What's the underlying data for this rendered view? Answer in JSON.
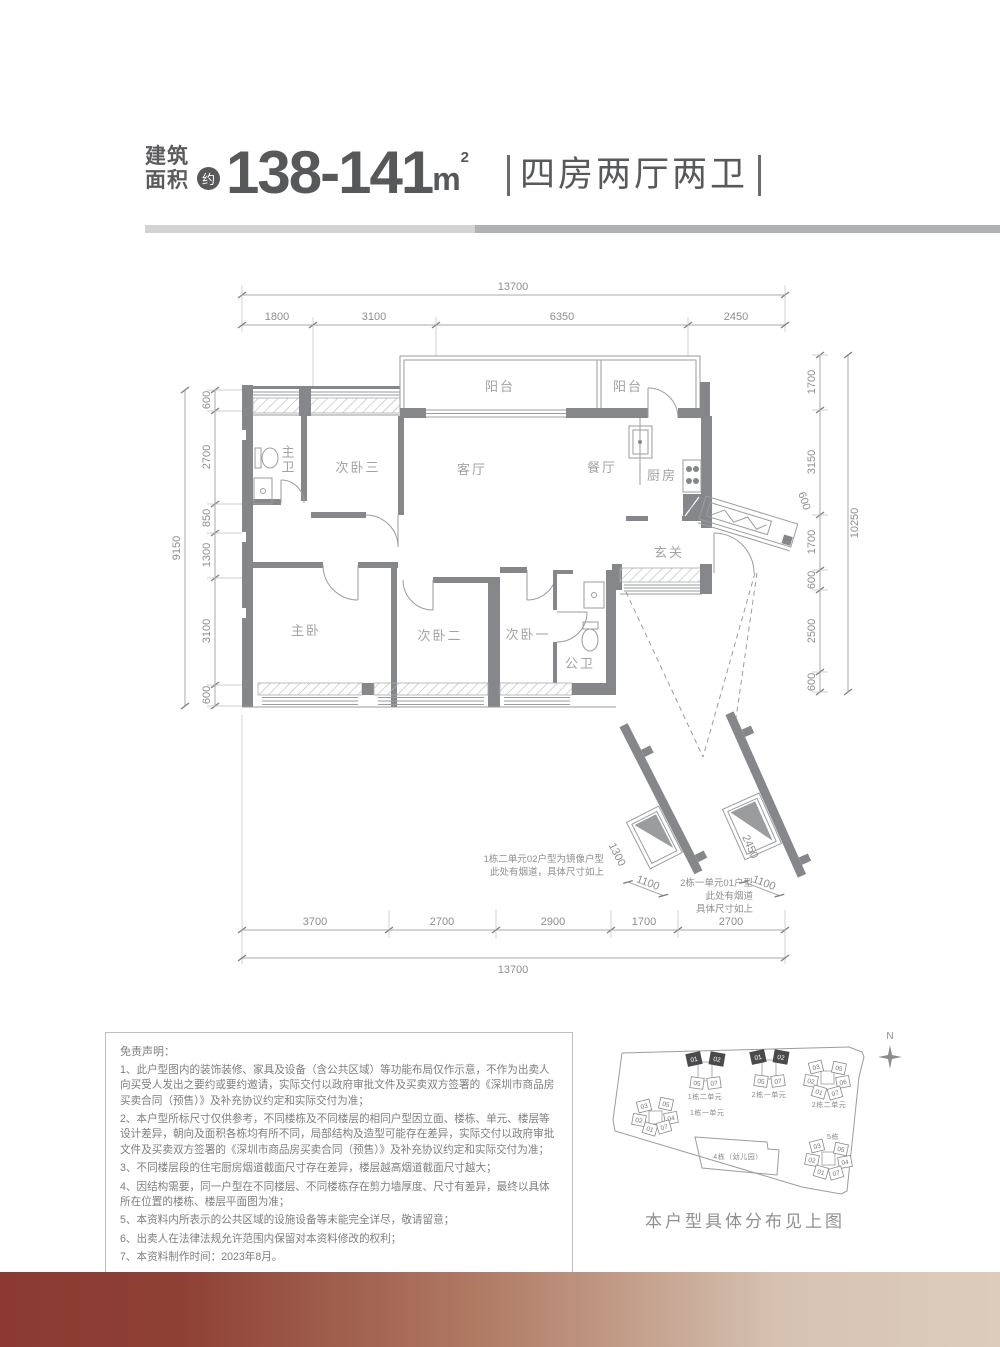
{
  "header": {
    "area_label_line1": "建筑",
    "area_label_line2": "面积",
    "approx_badge": "约",
    "area_value": "138-141",
    "area_unit": "m",
    "area_unit_sup": "2",
    "layout_text": "四房两厅两卫"
  },
  "floor_plan": {
    "rooms": {
      "balcony_left": "阳台",
      "balcony_right": "阳台",
      "master_bath": "主卫",
      "bedroom3": "次卧三",
      "living_room": "客厅",
      "dining_room": "餐厅",
      "kitchen": "厨房",
      "foyer": "玄关",
      "master_bedroom": "主卧",
      "bedroom2": "次卧二",
      "bedroom1": "次卧一",
      "public_bath": "公卫",
      "flue": "烟道"
    },
    "dims_top": {
      "overall": "13700",
      "segments": [
        "1800",
        "3100",
        "6350",
        "2450"
      ]
    },
    "dims_bottom": {
      "overall": "13700",
      "segments": [
        "3700",
        "2700",
        "2900",
        "1700",
        "2700"
      ]
    },
    "dims_left": {
      "overall": "9150",
      "segments": [
        "600",
        "2700",
        "850",
        "1300",
        "3100",
        "600"
      ]
    },
    "dims_right": {
      "overall": "10250",
      "segments": [
        "1700",
        "3150",
        "1700",
        "600",
        "2500",
        "600"
      ],
      "corridor_dim": "600"
    },
    "annotations": [
      {
        "lines": [
          "1栋二单元02户型为镜像户型",
          "此处有烟道，具体尺寸如上"
        ],
        "dims": [
          "1300",
          "1100"
        ]
      },
      {
        "lines": [
          "2栋一单元01户型",
          "此处有烟道",
          "具体尺寸如上"
        ],
        "dims": [
          "2450",
          "1100"
        ]
      }
    ]
  },
  "disclaimer": {
    "title": "免责声明：",
    "items": [
      "1、此户型图内的装饰装修、家具及设备（含公共区域）等功能布局仅作示意，不作为出卖人向买受人发出之要约或要约邀请，实际交付以政府审批文件及买卖双方签署的《深圳市商品房买卖合同（预售）》及补充协议约定和实际交付为准；",
      "2、本户型所标尺寸仅供参考，不同楼栋及不同楼层的相同户型因立面、楼栋、单元、楼层等设计差异，朝向及面积各栋均有所不同，局部结构及造型可能存在差异，实际交付以政府审批文件及买卖双方签署的《深圳市商品房买卖合同（预售）》及补充协议约定和实际交付为准；",
      "3、不同楼层段的住宅厨房烟道截面尺寸存在差异，楼层越高烟道截面尺寸越大；",
      "4、因结构需要，同一户型在不同楼层、不同楼栋存在剪力墙厚度、尺寸有差异，最终以具体所在位置的楼栋、楼层平面图为准；",
      "5、本资料内所表示的公共区域的设施设备等未能完全详尽，敬请留意；",
      "6、出卖人在法律法规允许范围内保留对本资料修改的权利；",
      "7、本资料制作时间：2023年8月。"
    ]
  },
  "site_plan": {
    "north_label": "N",
    "caption": "本户型具体分布见上图",
    "clusters": [
      {
        "label": "1栋二单元",
        "units": [
          {
            "n": "01",
            "dark": true
          },
          {
            "n": "02",
            "dark": true
          },
          {
            "n": "05",
            "dark": false
          },
          {
            "n": "07",
            "dark": false
          }
        ]
      },
      {
        "label": "2栋一单元",
        "units": [
          {
            "n": "01",
            "dark": true
          },
          {
            "n": "02",
            "dark": true
          },
          {
            "n": "05",
            "dark": false
          },
          {
            "n": "07",
            "dark": false
          }
        ]
      },
      {
        "label": "2栋二单元",
        "units": [
          {
            "n": "03",
            "dark": false
          },
          {
            "n": "05",
            "dark": false
          },
          {
            "n": "02",
            "dark": false
          },
          {
            "n": "06",
            "dark": false
          },
          {
            "n": "01",
            "dark": false
          },
          {
            "n": "07",
            "dark": false
          }
        ]
      },
      {
        "label": "1栋一单元",
        "units": [
          {
            "n": "03",
            "dark": false
          },
          {
            "n": "05",
            "dark": false
          },
          {
            "n": "02",
            "dark": false
          },
          {
            "n": "04",
            "dark": false
          },
          {
            "n": "01",
            "dark": false
          },
          {
            "n": "07",
            "dark": false
          }
        ]
      },
      {
        "label": "5栋",
        "units": [
          {
            "n": "03",
            "dark": false
          },
          {
            "n": "05",
            "dark": false
          },
          {
            "n": "02",
            "dark": false
          },
          {
            "n": "04",
            "dark": false
          },
          {
            "n": "01",
            "dark": false
          },
          {
            "n": "07",
            "dark": false
          }
        ]
      },
      {
        "label": "4栋（幼儿园）",
        "units": []
      }
    ]
  },
  "colors": {
    "accent_dark": "#8d3c33",
    "accent_light": "#d9c7b7",
    "wall_gray": "#85878a",
    "text_dark": "#58595b"
  }
}
